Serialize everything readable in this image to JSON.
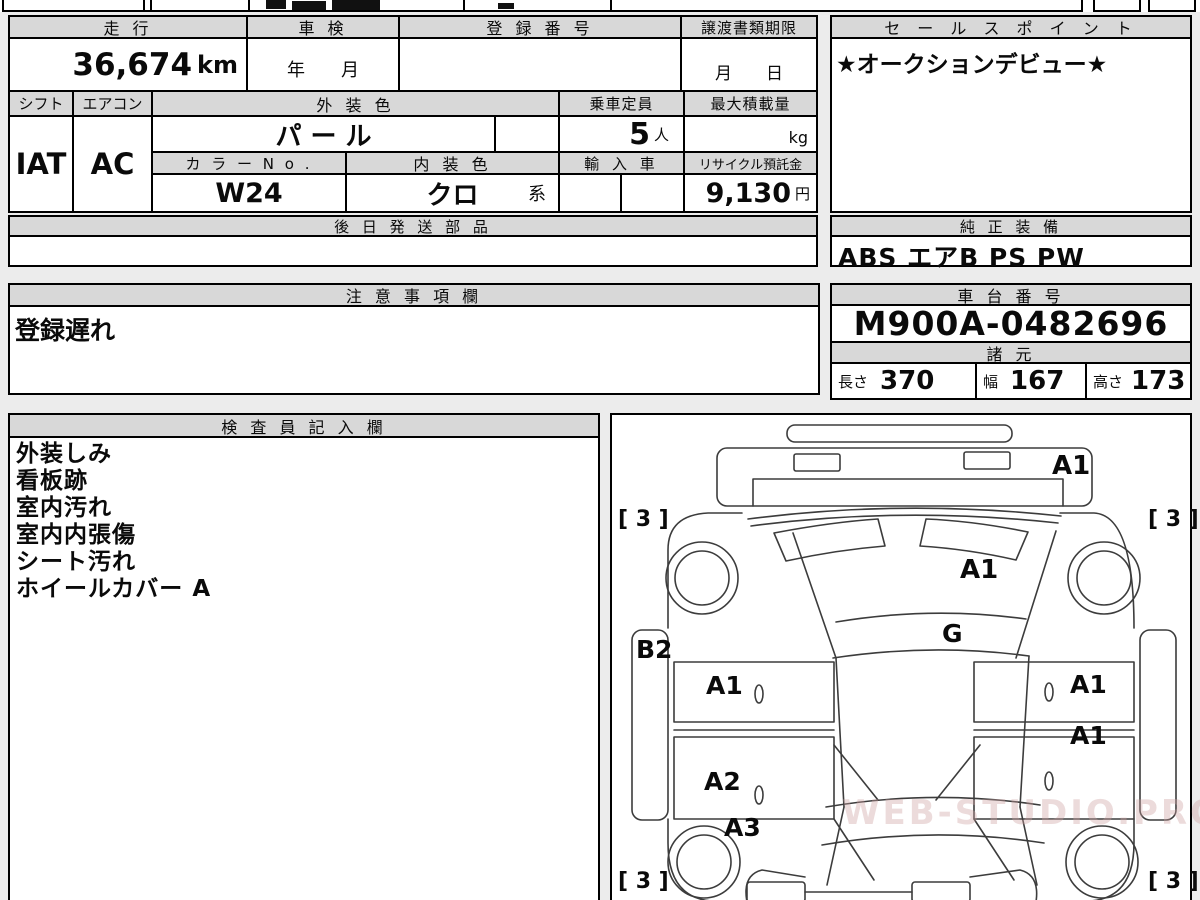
{
  "info_table": {
    "mileage_label": "走 行",
    "mileage_value": "36,674",
    "mileage_unit": "km",
    "shaken_label": "車 検",
    "shaken_value": "年　　月",
    "registration_label": "登 録 番 号",
    "registration_value": "",
    "transfer_label": "譲渡書類期限",
    "transfer_value": "月　　日",
    "shift_label": "シフト",
    "shift_value": "IAT",
    "aircon_label": "エアコン",
    "aircon_value": "AC",
    "exterior_color_label": "外 装 色",
    "exterior_color_value": "パ ー ル",
    "capacity_label": "乗車定員",
    "capacity_value": "5",
    "capacity_unit": "人",
    "max_load_label": "最大積載量",
    "max_load_unit": "kg",
    "color_no_label": "カ ラ ー N o .",
    "color_no_value": "W24",
    "interior_color_label": "内 装 色",
    "interior_color_value": "クロ",
    "interior_color_suffix": "系",
    "import_label": "輸 入 車",
    "recycle_label": "リサイクル預託金",
    "recycle_value": "9,130",
    "recycle_unit": "円"
  },
  "sales_point": {
    "label": "セ ー ル ス ポ イ ン ト",
    "value": "★オークションデビュー★"
  },
  "later_parts": {
    "label": "後 日 発 送 部 品",
    "value": ""
  },
  "genuine_equipment": {
    "label": "純 正 装 備",
    "value": "ABS エアB PS PW"
  },
  "notes": {
    "label": "注 意 事 項 欄",
    "value": "登録遅れ"
  },
  "chassis": {
    "label": "車 台 番 号",
    "value": "M900A-0482696"
  },
  "specs": {
    "label": "諸 元",
    "length_label": "長さ",
    "length_value": "370",
    "width_label": "幅",
    "width_value": "167",
    "height_label": "高さ",
    "height_value": "173"
  },
  "inspector": {
    "label": "検 査 員 記 入 欄",
    "items": [
      "外装しみ",
      "看板跡",
      "室内汚れ",
      "室内内張傷",
      "シート汚れ",
      "ホイールカバー A"
    ]
  },
  "diagram": {
    "labels": [
      {
        "text": "A1"
      },
      {
        "text": "[ 3 ]"
      },
      {
        "text": "[ 3 ]"
      },
      {
        "text": "A1"
      },
      {
        "text": "G"
      },
      {
        "text": "B2"
      },
      {
        "text": "A1"
      },
      {
        "text": "A1"
      },
      {
        "text": "A1"
      },
      {
        "text": "A2"
      },
      {
        "text": "A3"
      },
      {
        "text": "[ 3 ]"
      },
      {
        "text": "[ 3 ]"
      }
    ],
    "watermark": "WEB-STUDIO.PRO"
  },
  "colors": {
    "page_bg": "#ececec",
    "header_bg": "#d8d8d8",
    "border": "#000000",
    "line": "#3c3c3c"
  }
}
